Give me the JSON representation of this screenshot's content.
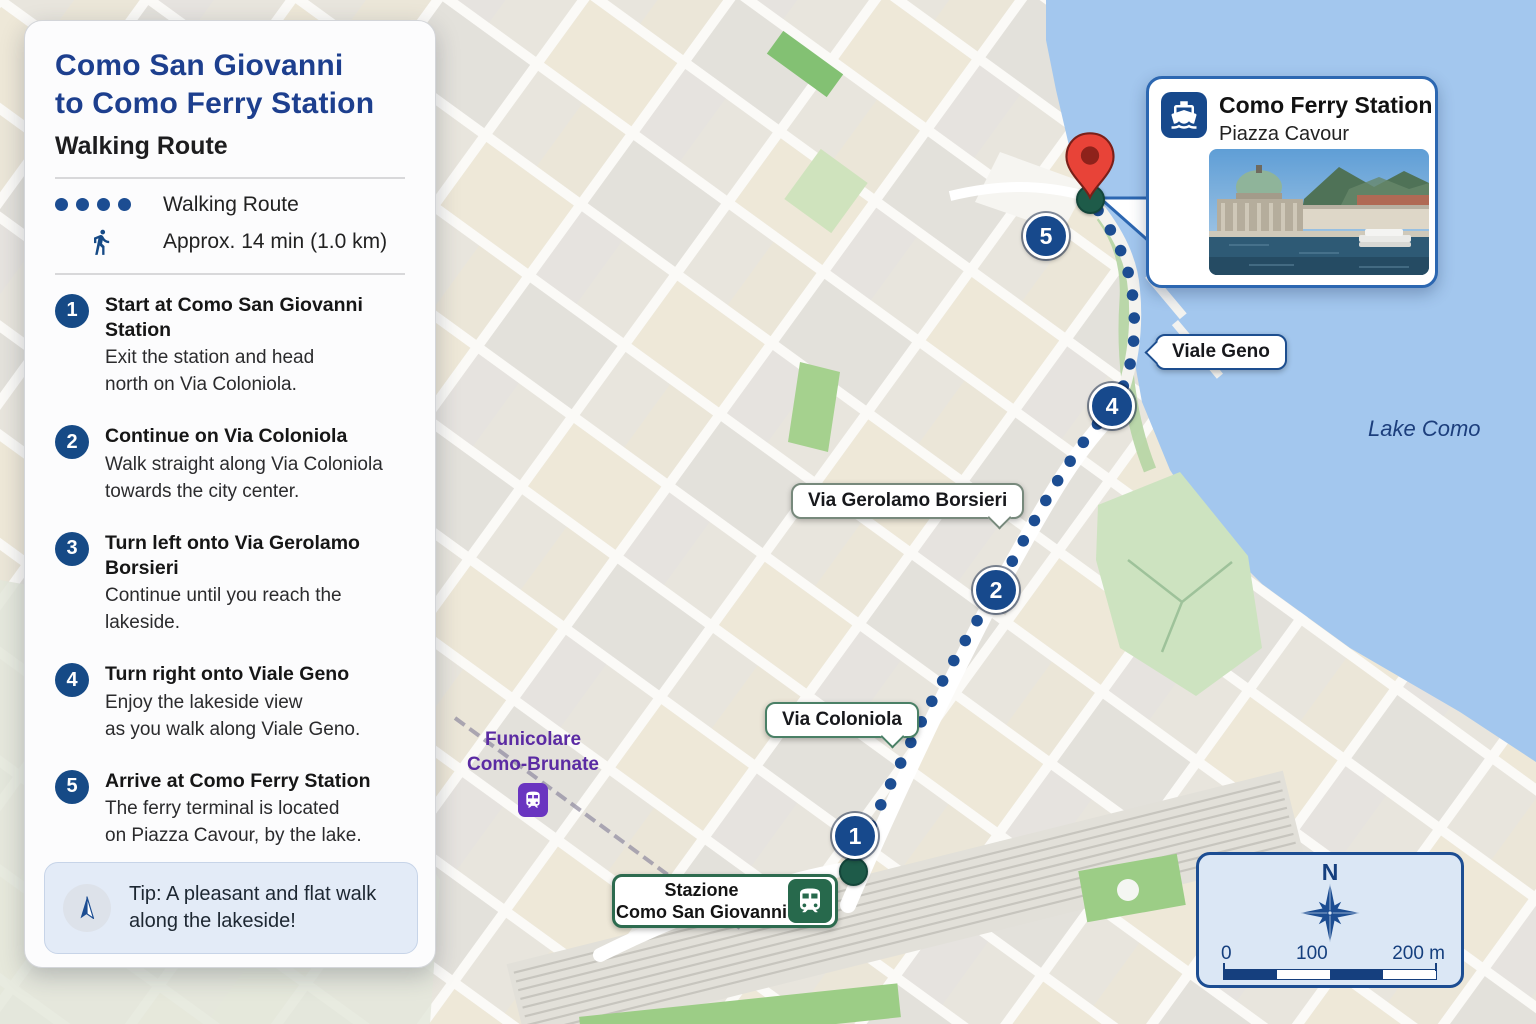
{
  "panel": {
    "title_line1": "Como San Giovanni",
    "title_line2": "to Como Ferry Station",
    "subtitle": "Walking Route",
    "legend_route_label": "Walking Route",
    "legend_duration": "Approx. 14 min (1.0 km)",
    "steps": [
      {
        "num": "1",
        "title": "Start at Como San Giovanni Station",
        "desc": "Exit the station and head\nnorth on Via Coloniola."
      },
      {
        "num": "2",
        "title": "Continue on Via Coloniola",
        "desc": "Walk straight along Via Coloniola\ntowards the city center."
      },
      {
        "num": "3",
        "title": "Turn left onto Via Gerolamo Borsieri",
        "desc": "Continue until you reach the lakeside."
      },
      {
        "num": "4",
        "title": "Turn right onto Viale Geno",
        "desc": "Enjoy the lakeside view\nas you walk along Viale Geno."
      },
      {
        "num": "5",
        "title": "Arrive at Como Ferry Station",
        "desc": "The ferry terminal is located\non Piazza Cavour, by the lake."
      }
    ],
    "tip": "Tip: A pleasant and flat walk\nalong the lakeside!"
  },
  "map": {
    "labels": {
      "duomo_line1": "DUOMO",
      "duomo_line2": "di Como",
      "piazza_del_duomo": "Piazza del\nDuomo",
      "teatro_sociale": "Teatro Sociale",
      "music_note": "♪",
      "piazza_cavour": "Piazza Cavour",
      "city": "COMO",
      "via_milano": "Via Milano",
      "via_alessandro_volta": "Via Alessandro Volta",
      "small_street": "Vtibo",
      "lake": "Lake Como",
      "funicolare_line1": "Funicolare",
      "funicolare_line2": "Como-Brunate",
      "stazione_line1": "Stazione",
      "stazione_line2": "Como San Giovanni"
    },
    "bubbles": {
      "via_coloniola": "Via Coloniola",
      "via_gerolamo_borsieri": "Via Gerolamo Borsieri",
      "viale_geno": "Viale Geno"
    },
    "markers": {
      "m1": "1",
      "m2": "2",
      "m4": "4",
      "m5": "5"
    }
  },
  "callout": {
    "title": "Como Ferry Station",
    "subtitle": "Piazza Cavour"
  },
  "compass": {
    "north_label": "N",
    "scale_0": "0",
    "scale_100": "100",
    "scale_200": "200 m"
  },
  "colors": {
    "accent_blue": "#1c4d92",
    "marker_blue": "#17498c",
    "station_green": "#27694c",
    "poi_purple": "#8a3fd1",
    "water": "#a3c7ee",
    "pin_red": "#e84338"
  }
}
